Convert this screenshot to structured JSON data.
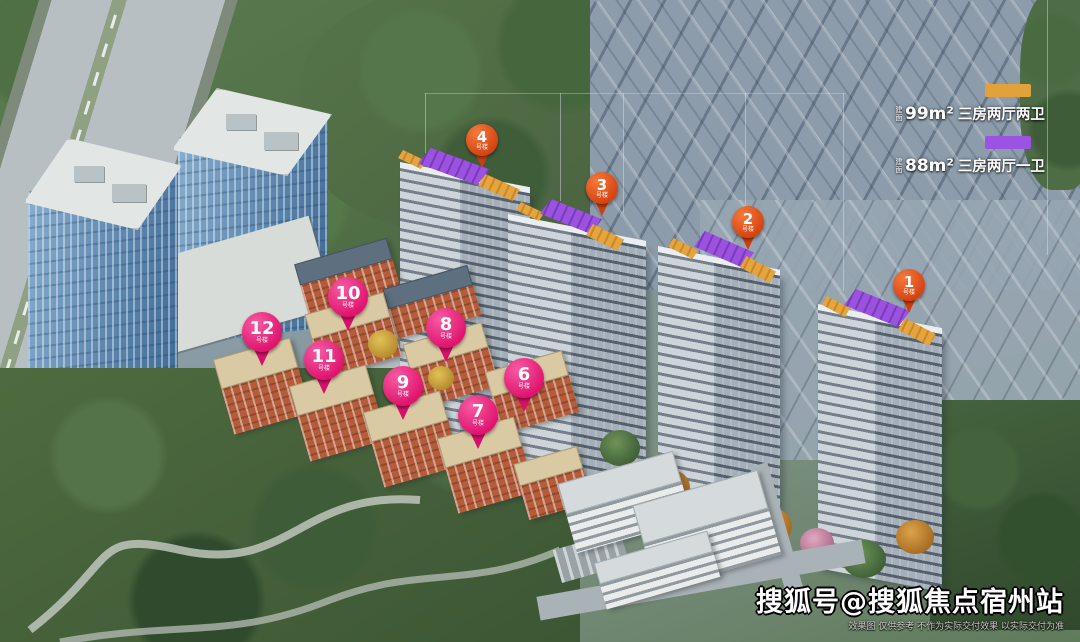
{
  "scene": {
    "type": "aerial-architectural-rendering",
    "description": "鸟瞰效果图：住宅小区高层塔楼、洋房、商业及办公楼"
  },
  "legend": {
    "items": [
      {
        "prefix": "建面",
        "area": "99m²",
        "rooms": "三房两厅两卫",
        "swatch_color": "#E2A23B"
      },
      {
        "prefix": "建面",
        "area": "88m²",
        "rooms": "三房两厅一卫",
        "swatch_color": "#9C52E2"
      }
    ]
  },
  "markers": {
    "towers": [
      {
        "number": "4",
        "suffix": "号楼"
      },
      {
        "number": "3",
        "suffix": "号楼"
      },
      {
        "number": "2",
        "suffix": "号楼"
      },
      {
        "number": "1",
        "suffix": "号楼"
      }
    ],
    "lowrise": [
      {
        "number": "10",
        "suffix": "号楼"
      },
      {
        "number": "12",
        "suffix": "号楼"
      },
      {
        "number": "8",
        "suffix": "号楼"
      },
      {
        "number": "11",
        "suffix": "号楼"
      },
      {
        "number": "6",
        "suffix": "号楼"
      },
      {
        "number": "9",
        "suffix": "号楼"
      },
      {
        "number": "7",
        "suffix": "号楼"
      }
    ],
    "pin_colors": {
      "tower": "#D64312",
      "lowrise": "#E0146E"
    }
  },
  "watermark": {
    "account": "搜狐号@搜狐焦点宿州站",
    "disclaimer": "效果图 仅供参考 不作为实际交付效果 以实际交付为准"
  }
}
